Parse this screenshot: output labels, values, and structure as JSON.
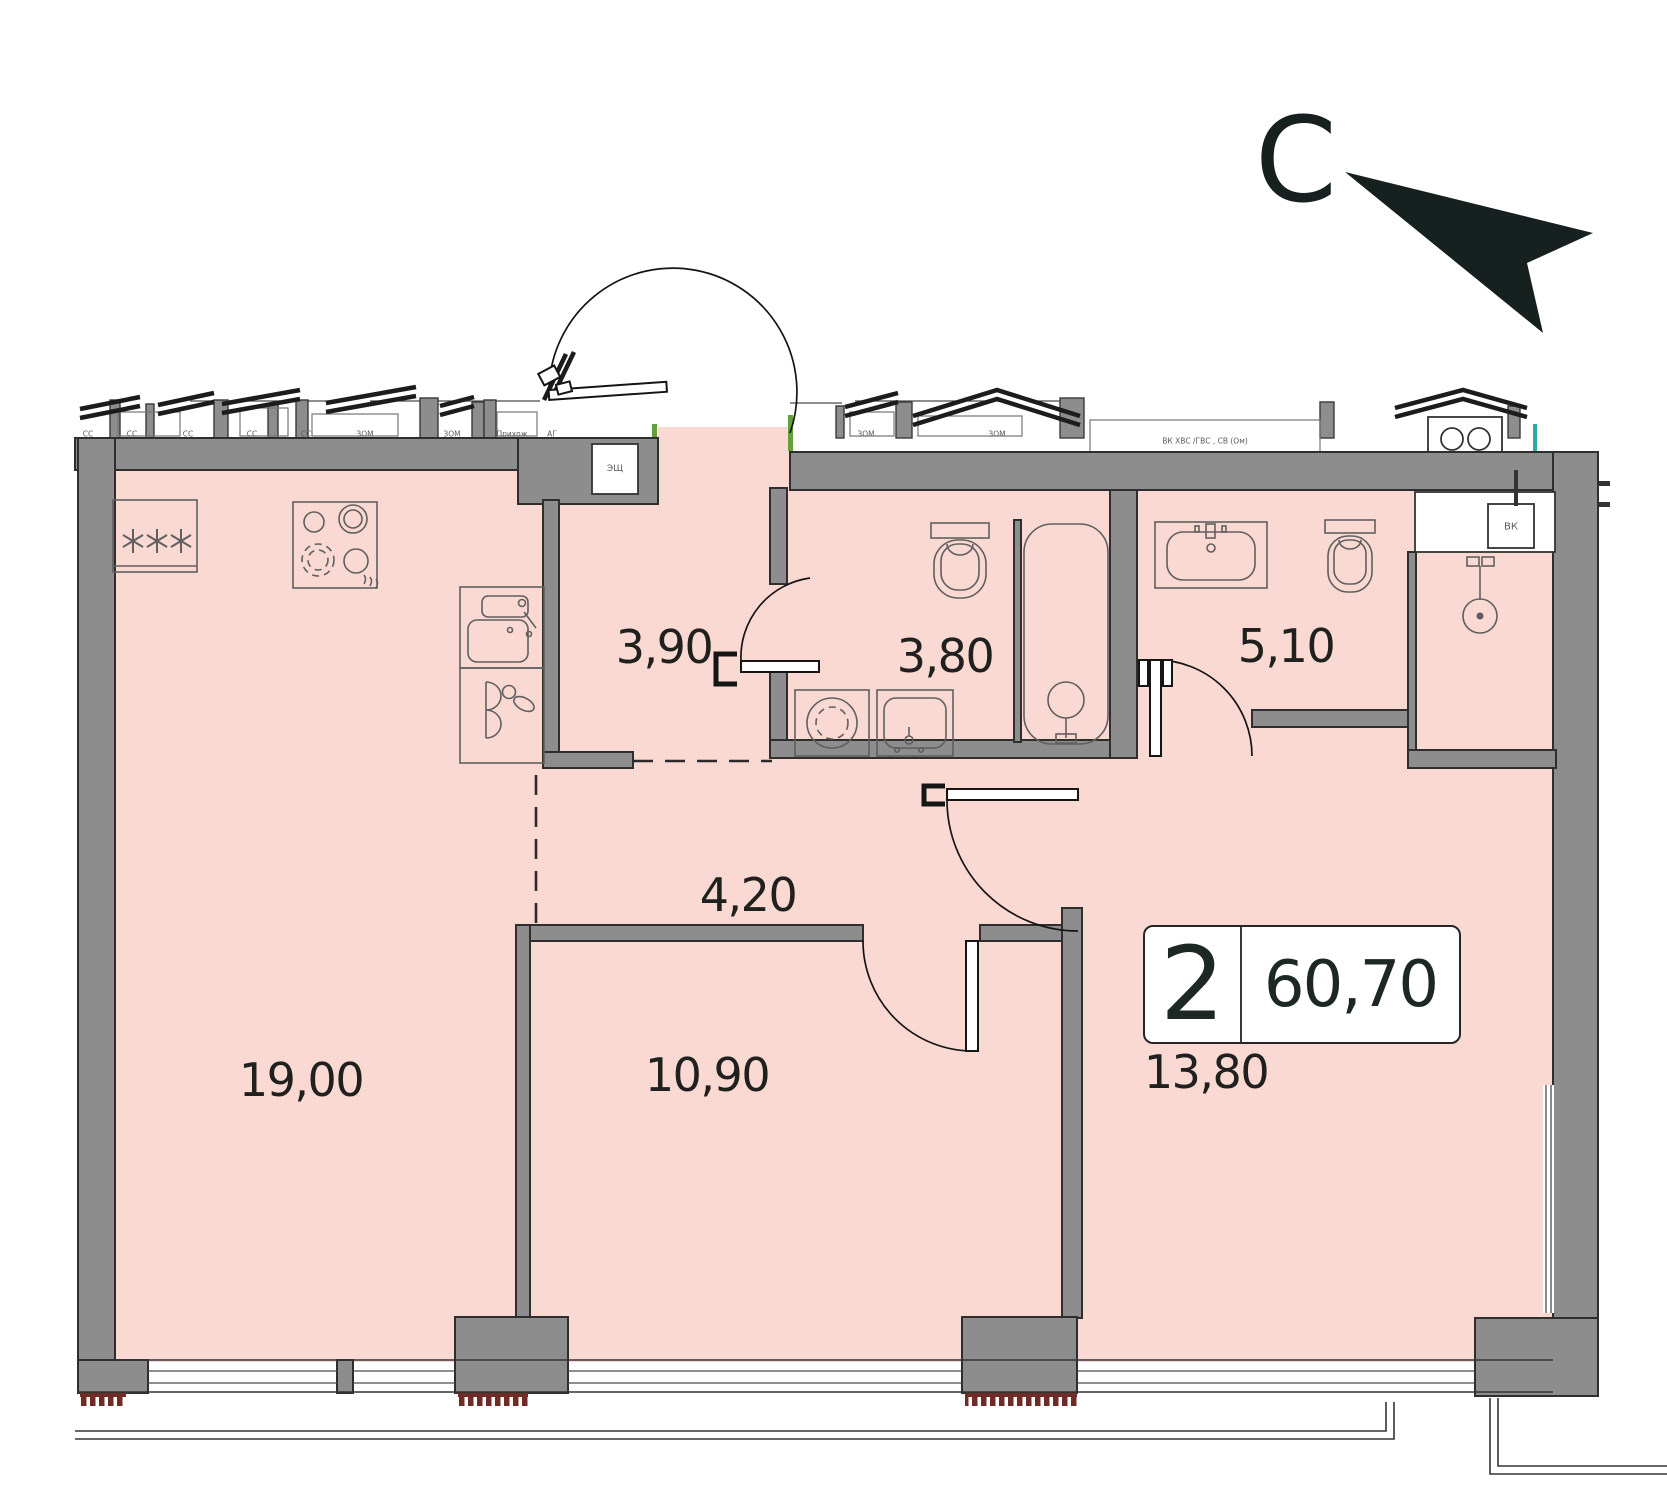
{
  "north_arrow": {
    "label": "С"
  },
  "info_badge": {
    "rooms_count": "2",
    "total_area": "60,70"
  },
  "room_areas": {
    "kitchen_living": "19,00",
    "hallway": "3,90",
    "bathroom": "3,80",
    "wc": "5,10",
    "corridor": "4,20",
    "bedroom": "10,90",
    "living_room": "13,80"
  },
  "wall_annotations": {
    "electrical_shaft": "ЭЩ",
    "vk_shaft": "ВК",
    "utilities": "ВК ХВС /ГВС , СВ (Ом)",
    "neighbor_rooms": [
      "СС",
      "СС",
      "СС",
      "СС",
      "СС",
      "ЗОМ",
      "ЗОМ",
      "Прихож",
      "АГ",
      "ЗОМ",
      "ЗОМ"
    ]
  },
  "colors": {
    "floor_pink": "#fbd9d3",
    "wall_gray": "#8d8d8d",
    "ink": "#20201e",
    "fixture_line": "#5f5f5f",
    "comb_red": "#6f2b26",
    "teal_accent": "#2fa9a3",
    "green_accent": "#63a03c"
  }
}
